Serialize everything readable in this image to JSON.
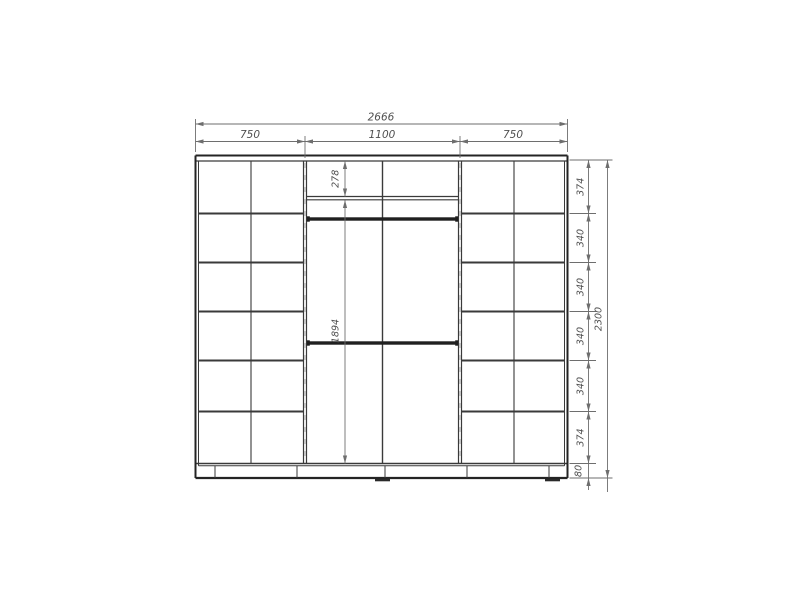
{
  "diagram": {
    "title": "wardrobe-front-elevation-drawing",
    "colors": {
      "background": "#ffffff",
      "structure_line": "#3a3a3a",
      "dimension_line": "#6e6e6e",
      "label_text": "#4f4f4f"
    },
    "dim_overall_width": "2666",
    "dim_top_segments": [
      "750",
      "1100",
      "750"
    ],
    "dim_overall_height": "2300",
    "dim_right_segments": [
      "374",
      "340",
      "340",
      "340",
      "340",
      "374",
      "80"
    ],
    "dim_middle_upper": "278",
    "dim_middle_lower": "1894"
  }
}
